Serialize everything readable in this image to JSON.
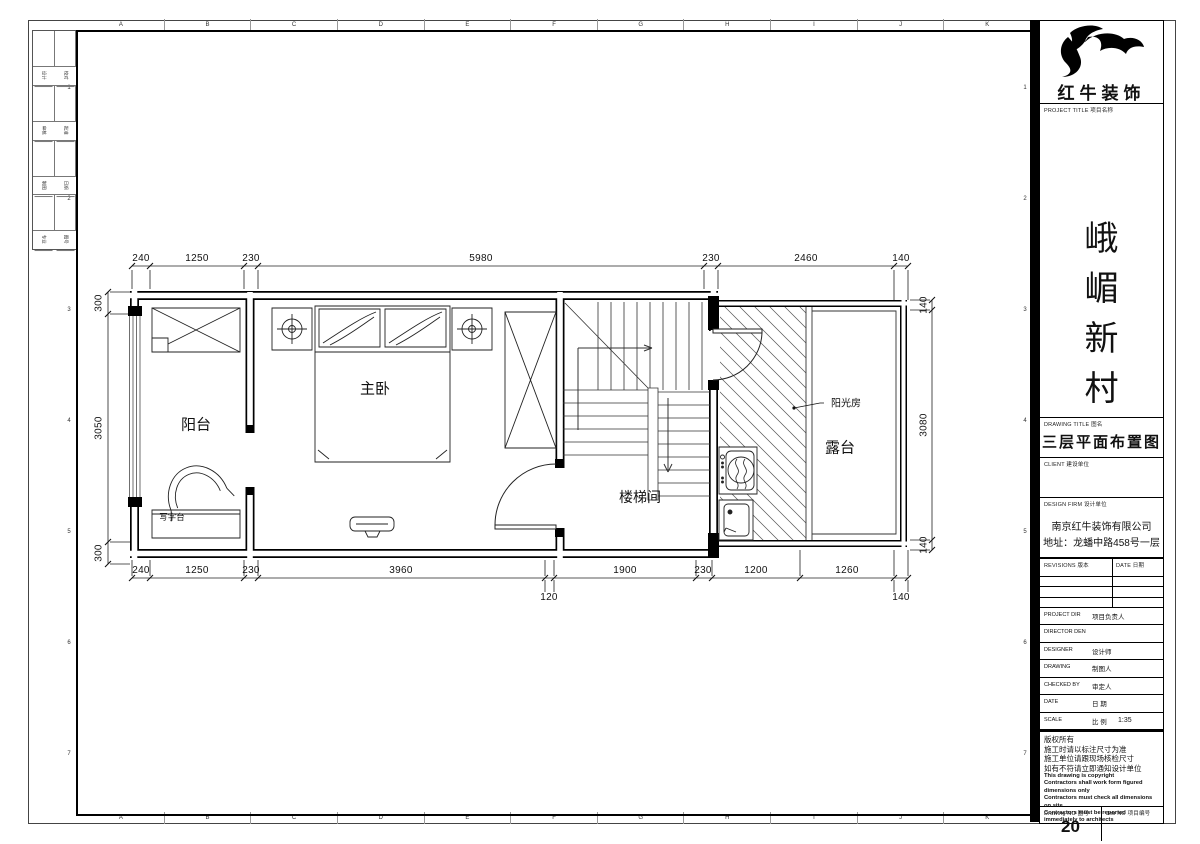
{
  "frame": {
    "cols": [
      "A",
      "B",
      "C",
      "D",
      "E",
      "F",
      "G",
      "H",
      "I",
      "J",
      "K"
    ],
    "rows": [
      "1",
      "2",
      "3",
      "4",
      "5",
      "6",
      "7"
    ],
    "filing_strip": [
      {
        "a": "设计",
        "b": "校对"
      },
      {
        "a": "审核",
        "b": "批准"
      },
      {
        "a": "制图",
        "b": "日期"
      },
      {
        "a": "专业",
        "b": "图号"
      }
    ]
  },
  "brand": {
    "company_name": "红牛装饰",
    "logo_icon": "bull-swoosh"
  },
  "title_block": {
    "project_label": "PROJECT TITLE  项目名称",
    "project_name_chars": [
      "峨",
      "嵋",
      "新",
      "村"
    ],
    "drawing_title_label": "DRAWING TITLE  图名",
    "drawing_title": "三层平面布置图",
    "client_label": "CLIENT  建设单位",
    "design_firm_label": "DESIGN FIRM  设计单位",
    "design_firm_name": "南京红牛装饰有限公司",
    "design_firm_address": "地址：龙蟠中路458号一层",
    "revisions_label": "REVISIONS  版本",
    "date_col_label": "DATE  日期",
    "rows": [
      {
        "en": "PROJECT DIR",
        "zh": "项目负责人",
        "value": ""
      },
      {
        "en": "DIRECTOR DEN",
        "zh": "",
        "value": ""
      },
      {
        "en": "DESIGNER",
        "zh": "设计师",
        "value": ""
      },
      {
        "en": "DRAWING",
        "zh": "制图人",
        "value": ""
      },
      {
        "en": "CHECKED BY",
        "zh": "审定人",
        "value": ""
      },
      {
        "en": "DATE",
        "zh": "日 期",
        "value": ""
      },
      {
        "en": "SCALE",
        "zh": "比 例",
        "value": "1:35"
      }
    ],
    "notes_zh": [
      "版权所有",
      "施工时请以标注尺寸为准",
      "施工单位请跟现场核检尺寸",
      "如有不符请立即通知设计单位"
    ],
    "notes_en": [
      "This drawing is copyright",
      "Contractors shall work form figured dimensions only",
      "Contractors must check all dimensions on site",
      "Contractors must be reported immediately to architects"
    ],
    "drawing_no_label": "Drawing NO  图号",
    "drawing_no": "20",
    "job_no_label": "Job NO  项目编号",
    "job_no": ""
  },
  "plan": {
    "rooms": [
      {
        "name": "阳台"
      },
      {
        "name": "主卧"
      },
      {
        "name": "楼梯间"
      },
      {
        "name": "露台"
      }
    ],
    "annotations": {
      "desk": "写字台",
      "sunroom": "阳光房"
    },
    "dims": {
      "top": [
        "240",
        "1250",
        "230",
        "5980",
        "230",
        "2460",
        "140"
      ],
      "bottom": [
        "240",
        "1250",
        "230",
        "3960",
        "1900",
        "230",
        "1200",
        "1260"
      ],
      "bottom2": [
        "120",
        "140"
      ],
      "left": [
        "300",
        "3050",
        "300"
      ],
      "right": [
        "140",
        "3080",
        "140"
      ]
    }
  }
}
